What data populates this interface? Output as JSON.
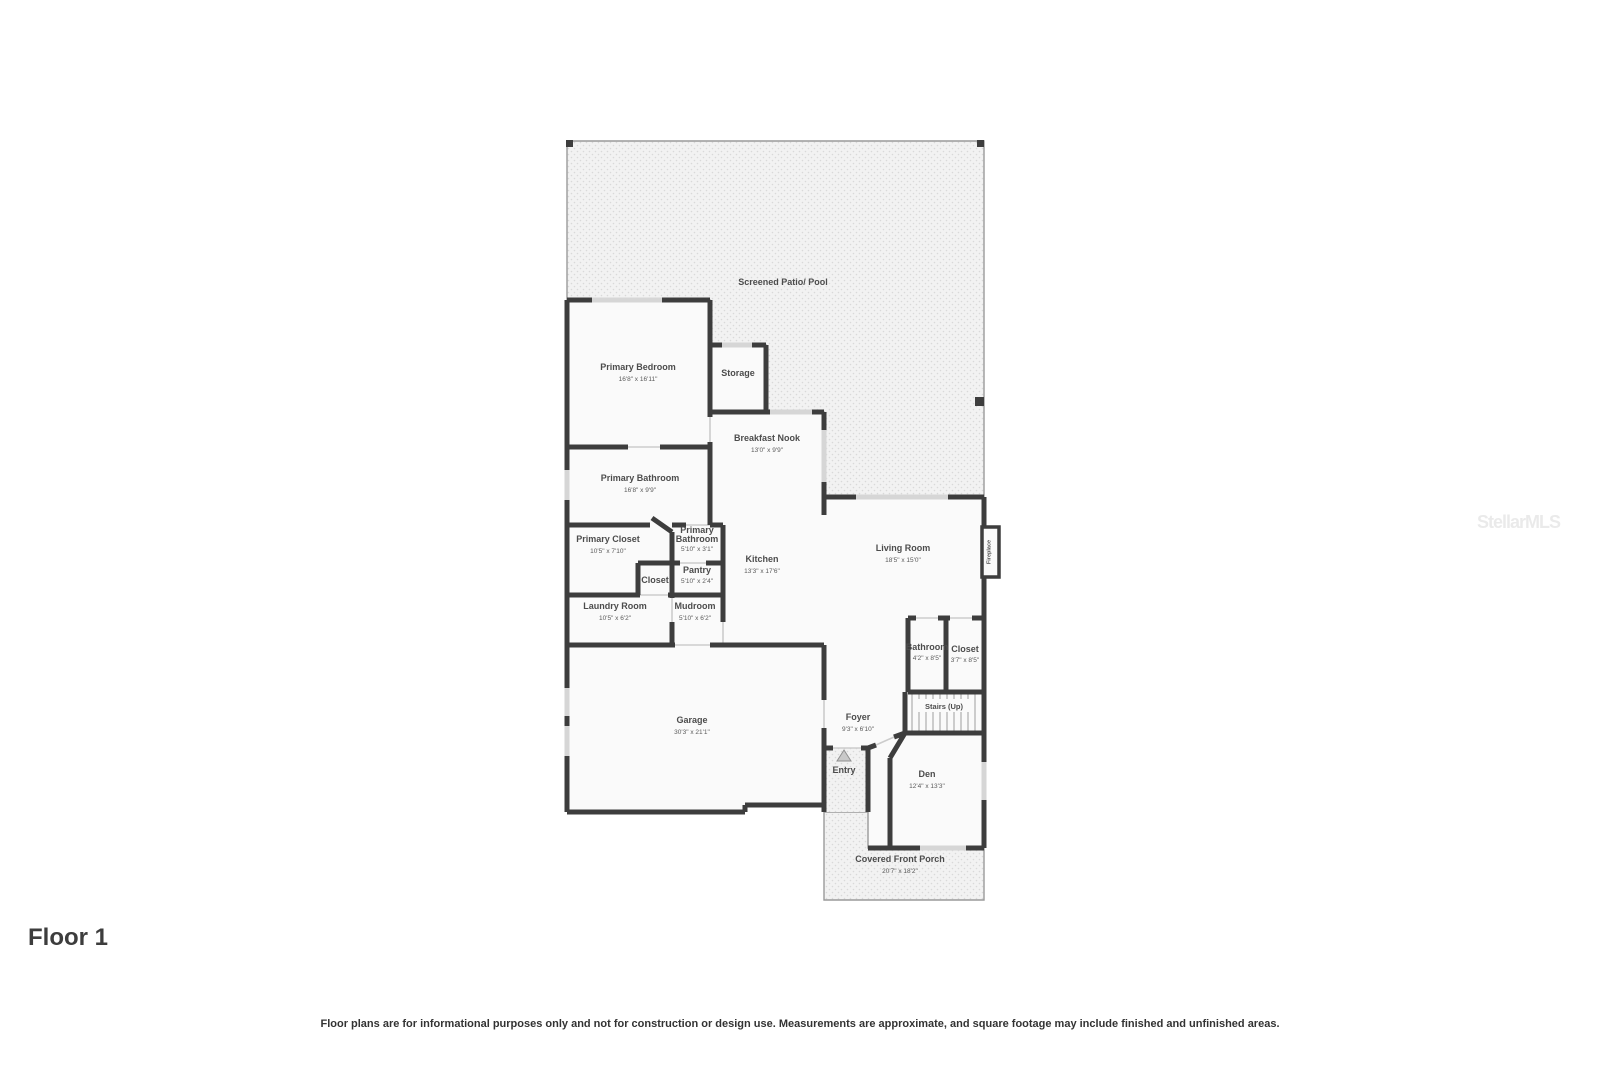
{
  "page": {
    "floor_label": "Floor 1",
    "disclaimer": "Floor plans are for informational purposes only and not for construction or design use. Measurements are approximate, and square footage may include finished and unfinished areas.",
    "watermark": "StellarMLS"
  },
  "colors": {
    "wall": "#3d3d3d",
    "room_fill": "#fafafa",
    "patio_fill": "#f2f2f2",
    "patio_dot": "#d9d9d9",
    "window": "#d6d6d6",
    "label_text": "#4c4c4c"
  },
  "rooms": {
    "screened_patio": {
      "name": "Screened Patio/ Pool"
    },
    "primary_bedroom": {
      "name": "Primary Bedroom",
      "dims": "16'8\" x 16'11\""
    },
    "storage": {
      "name": "Storage"
    },
    "breakfast_nook": {
      "name": "Breakfast Nook",
      "dims": "13'0\" x 9'9\""
    },
    "primary_bathroom": {
      "name": "Primary Bathroom",
      "dims": "16'8\" x 9'9\""
    },
    "primary_closet": {
      "name": "Primary Closet",
      "dims": "10'5\" x 7'10\""
    },
    "primary_bathroom_2": {
      "line1": "Primary",
      "line2": "Bathroom",
      "dims": "5'10\" x 3'1\""
    },
    "closet": {
      "name": "Closet"
    },
    "pantry": {
      "name": "Pantry",
      "dims": "5'10\" x 2'4\""
    },
    "kitchen": {
      "name": "Kitchen",
      "dims": "13'3\" x 17'6\""
    },
    "living_room": {
      "name": "Living Room",
      "dims": "18'5\" x 15'0\""
    },
    "fireplace": {
      "name": "Fireplace"
    },
    "laundry_room": {
      "name": "Laundry Room",
      "dims": "10'5\" x 6'2\""
    },
    "mudroom": {
      "name": "Mudroom",
      "dims": "5'10\" x 6'2\""
    },
    "garage": {
      "name": "Garage",
      "dims": "30'3\" x 21'1\""
    },
    "bathroom": {
      "name": "Bathroom",
      "dims": "4'2\" x 8'5\""
    },
    "closet_2": {
      "name": "Closet",
      "dims": "3'7\" x 8'5\""
    },
    "stairs": {
      "name": "Stairs (Up)"
    },
    "foyer": {
      "name": "Foyer",
      "dims": "9'3\" x 6'10\""
    },
    "entry": {
      "name": "Entry"
    },
    "den": {
      "name": "Den",
      "dims": "12'4\" x 13'3\""
    },
    "covered_front_porch": {
      "name": "Covered Front Porch",
      "dims": "20'7\" x 18'2\""
    }
  }
}
